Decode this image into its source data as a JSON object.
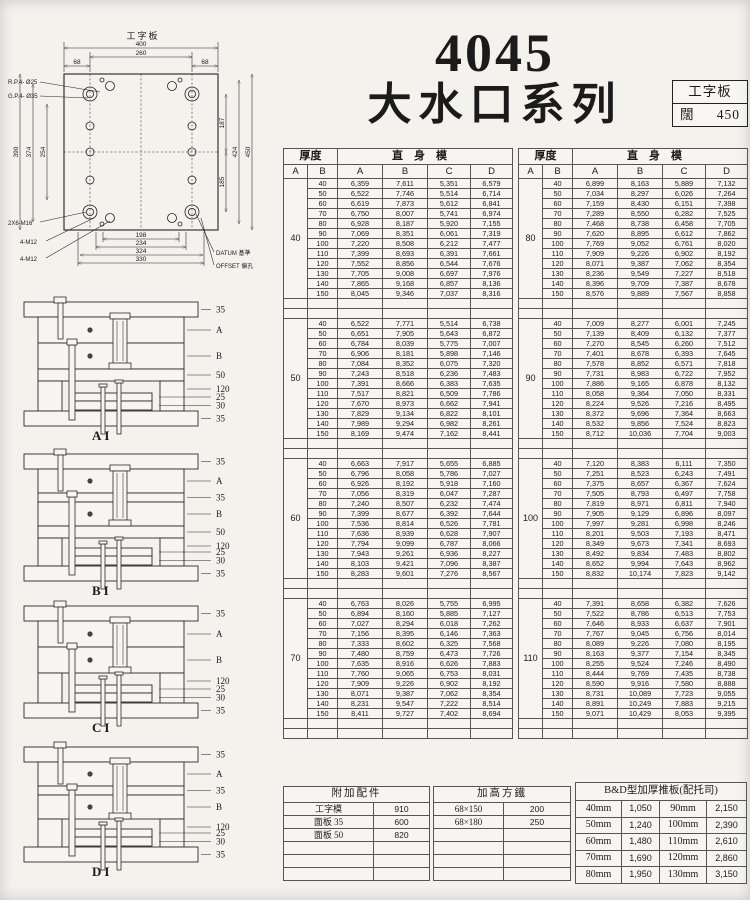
{
  "theme": {
    "paper": "#f3f2ed",
    "ink": "#1b1b1b"
  },
  "header": {
    "model": "4045",
    "series": "大水口系列",
    "spec_box": {
      "row1": "工字板",
      "row2_label": "闊",
      "row2_value": "450"
    }
  },
  "plan": {
    "label": "工字板",
    "dims": {
      "overall_w": "400",
      "inner_w": "260",
      "edge_l": "68",
      "edge_r": "68",
      "left_outer": "390",
      "left_mid": "374",
      "left_inner": "254",
      "right_top": "187",
      "right_bottom": "185",
      "right_outer1": "424",
      "right_outer2": "450",
      "bottom1": "198",
      "bottom2": "234",
      "bottom3": "324",
      "bottom4": "330"
    },
    "annotations": {
      "rp": "R.P.4- Ø25",
      "gp": "G.P.4- Ø35",
      "m16": "2X6-M16",
      "m12_upper": "4-M12",
      "m12_lower": "4-M12",
      "datum": "DATUM 基準",
      "offset": "OFFSET 偏孔"
    }
  },
  "cross_sections": [
    {
      "caption": "AI",
      "labels": [
        "35",
        "A",
        "B",
        "50",
        "120",
        "25",
        "30",
        "35"
      ]
    },
    {
      "caption": "BI",
      "labels": [
        "35",
        "A",
        "35",
        "B",
        "50",
        "120",
        "25",
        "30",
        "35"
      ]
    },
    {
      "caption": "CI",
      "labels": [
        "35",
        "A",
        "B",
        "120",
        "25",
        "30",
        "35"
      ]
    },
    {
      "caption": "DI",
      "labels": [
        "35",
        "A",
        "35",
        "B",
        "120",
        "25",
        "30",
        "35"
      ]
    }
  ],
  "price_tables": [
    {
      "thickness_header": "厚度",
      "straight_header": "直身模",
      "sub_cols": [
        "A",
        "B",
        "A",
        "B",
        "C",
        "D"
      ],
      "groups": [
        {
          "thickness": "40",
          "rows": [
            [
              "40",
              "6,359",
              "7,611",
              "5,351",
              "6,579"
            ],
            [
              "50",
              "6,522",
              "7,746",
              "5,514",
              "6,714"
            ],
            [
              "60",
              "6,619",
              "7,873",
              "5,612",
              "6,841"
            ],
            [
              "70",
              "6,750",
              "8,007",
              "5,741",
              "6,974"
            ],
            [
              "80",
              "6,928",
              "8,187",
              "5,920",
              "7,155"
            ],
            [
              "90",
              "7,069",
              "8,351",
              "6,061",
              "7,319"
            ],
            [
              "100",
              "7,220",
              "8,508",
              "6,212",
              "7,477"
            ],
            [
              "110",
              "7,399",
              "8,693",
              "6,391",
              "7,661"
            ],
            [
              "120",
              "7,552",
              "8,856",
              "6,544",
              "7,676"
            ],
            [
              "130",
              "7,705",
              "9,008",
              "6,697",
              "7,976"
            ],
            [
              "140",
              "7,865",
              "9,168",
              "6,857",
              "8,136"
            ],
            [
              "150",
              "8,045",
              "9,346",
              "7,037",
              "8,316"
            ]
          ]
        },
        {
          "thickness": "50",
          "rows": [
            [
              "40",
              "6,522",
              "7,771",
              "5,514",
              "6,738"
            ],
            [
              "50",
              "6,651",
              "7,905",
              "5,643",
              "6,872"
            ],
            [
              "60",
              "6,784",
              "8,039",
              "5,775",
              "7,007"
            ],
            [
              "70",
              "6,906",
              "8,181",
              "5,898",
              "7,146"
            ],
            [
              "80",
              "7,084",
              "8,352",
              "6,075",
              "7,320"
            ],
            [
              "90",
              "7,243",
              "8,518",
              "6,236",
              "7,483"
            ],
            [
              "100",
              "7,391",
              "8,666",
              "6,383",
              "7,635"
            ],
            [
              "110",
              "7,517",
              "8,821",
              "6,509",
              "7,786"
            ],
            [
              "120",
              "7,670",
              "8,973",
              "6,662",
              "7,941"
            ],
            [
              "130",
              "7,829",
              "9,134",
              "6,822",
              "8,101"
            ],
            [
              "140",
              "7,989",
              "9,294",
              "6,982",
              "8,261"
            ],
            [
              "150",
              "8,169",
              "9,474",
              "7,162",
              "8,441"
            ]
          ]
        },
        {
          "thickness": "60",
          "rows": [
            [
              "40",
              "6,663",
              "7,917",
              "5,655",
              "6,885"
            ],
            [
              "50",
              "6,796",
              "8,058",
              "5,786",
              "7,027"
            ],
            [
              "60",
              "6,926",
              "8,192",
              "5,918",
              "7,160"
            ],
            [
              "70",
              "7,056",
              "8,319",
              "6,047",
              "7,287"
            ],
            [
              "80",
              "7,240",
              "8,507",
              "6,232",
              "7,474"
            ],
            [
              "90",
              "7,399",
              "8,677",
              "6,392",
              "7,644"
            ],
            [
              "100",
              "7,536",
              "8,814",
              "6,526",
              "7,781"
            ],
            [
              "110",
              "7,636",
              "8,939",
              "6,628",
              "7,907"
            ],
            [
              "120",
              "7,794",
              "9,099",
              "6,787",
              "8,066"
            ],
            [
              "130",
              "7,943",
              "9,261",
              "6,936",
              "8,227"
            ],
            [
              "140",
              "8,103",
              "9,421",
              "7,096",
              "8,387"
            ],
            [
              "150",
              "8,283",
              "9,601",
              "7,276",
              "8,567"
            ]
          ]
        },
        {
          "thickness": "70",
          "rows": [
            [
              "40",
              "6,763",
              "8,026",
              "5,755",
              "6,995"
            ],
            [
              "50",
              "6,894",
              "8,160",
              "5,885",
              "7,127"
            ],
            [
              "60",
              "7,027",
              "8,294",
              "6,018",
              "7,262"
            ],
            [
              "70",
              "7,156",
              "8,395",
              "6,146",
              "7,363"
            ],
            [
              "80",
              "7,333",
              "8,602",
              "6,325",
              "7,568"
            ],
            [
              "90",
              "7,480",
              "8,759",
              "6,473",
              "7,726"
            ],
            [
              "100",
              "7,635",
              "8,916",
              "6,626",
              "7,883"
            ],
            [
              "110",
              "7,760",
              "9,065",
              "6,753",
              "8,031"
            ],
            [
              "120",
              "7,909",
              "9,226",
              "6,902",
              "8,192"
            ],
            [
              "130",
              "8,071",
              "9,387",
              "7,062",
              "8,354"
            ],
            [
              "140",
              "8,231",
              "9,547",
              "7,222",
              "8,514"
            ],
            [
              "150",
              "8,411",
              "9,727",
              "7,402",
              "8,694"
            ]
          ]
        }
      ]
    },
    {
      "thickness_header": "厚度",
      "straight_header": "直身模",
      "sub_cols": [
        "A",
        "B",
        "A",
        "B",
        "C",
        "D"
      ],
      "groups": [
        {
          "thickness": "80",
          "rows": [
            [
              "40",
              "6,899",
              "8,163",
              "5,889",
              "7,132"
            ],
            [
              "50",
              "7,034",
              "8,297",
              "6,026",
              "7,264"
            ],
            [
              "60",
              "7,159",
              "8,430",
              "6,151",
              "7,398"
            ],
            [
              "70",
              "7,289",
              "8,550",
              "6,282",
              "7,525"
            ],
            [
              "80",
              "7,468",
              "8,738",
              "6,458",
              "7,705"
            ],
            [
              "90",
              "7,620",
              "8,895",
              "6,612",
              "7,862"
            ],
            [
              "100",
              "7,769",
              "9,052",
              "6,761",
              "8,020"
            ],
            [
              "110",
              "7,909",
              "9,226",
              "6,902",
              "8,192"
            ],
            [
              "120",
              "8,071",
              "9,387",
              "7,062",
              "8,354"
            ],
            [
              "130",
              "8,236",
              "9,549",
              "7,227",
              "8,518"
            ],
            [
              "140",
              "8,396",
              "9,709",
              "7,387",
              "8,678"
            ],
            [
              "150",
              "8,576",
              "9,889",
              "7,567",
              "8,858"
            ]
          ]
        },
        {
          "thickness": "90",
          "rows": [
            [
              "40",
              "7,009",
              "8,277",
              "6,001",
              "7,245"
            ],
            [
              "50",
              "7,139",
              "8,409",
              "6,132",
              "7,377"
            ],
            [
              "60",
              "7,270",
              "8,545",
              "6,260",
              "7,512"
            ],
            [
              "70",
              "7,401",
              "8,678",
              "6,393",
              "7,645"
            ],
            [
              "80",
              "7,578",
              "8,852",
              "6,571",
              "7,818"
            ],
            [
              "90",
              "7,731",
              "8,983",
              "6,722",
              "7,952"
            ],
            [
              "100",
              "7,886",
              "9,165",
              "6,878",
              "8,132"
            ],
            [
              "110",
              "8,058",
              "9,364",
              "7,050",
              "8,331"
            ],
            [
              "120",
              "8,224",
              "9,526",
              "7,216",
              "8,495"
            ],
            [
              "130",
              "8,372",
              "9,696",
              "7,364",
              "8,663"
            ],
            [
              "140",
              "8,532",
              "9,856",
              "7,524",
              "8,823"
            ],
            [
              "150",
              "8,712",
              "10,036",
              "7,704",
              "9,003"
            ]
          ]
        },
        {
          "thickness": "100",
          "rows": [
            [
              "40",
              "7,120",
              "8,383",
              "6,111",
              "7,350"
            ],
            [
              "50",
              "7,251",
              "8,523",
              "6,243",
              "7,491"
            ],
            [
              "60",
              "7,375",
              "8,657",
              "6,367",
              "7,624"
            ],
            [
              "70",
              "7,505",
              "8,793",
              "6,497",
              "7,758"
            ],
            [
              "80",
              "7,819",
              "8,971",
              "6,811",
              "7,940"
            ],
            [
              "90",
              "7,905",
              "9,129",
              "6,896",
              "8,097"
            ],
            [
              "100",
              "7,997",
              "9,281",
              "6,998",
              "8,246"
            ],
            [
              "110",
              "8,201",
              "9,503",
              "7,193",
              "8,471"
            ],
            [
              "120",
              "8,349",
              "9,673",
              "7,341",
              "8,693"
            ],
            [
              "130",
              "8,492",
              "9,834",
              "7,483",
              "8,802"
            ],
            [
              "140",
              "8,652",
              "9,994",
              "7,643",
              "8,962"
            ],
            [
              "150",
              "8,832",
              "10,174",
              "7,823",
              "9,142"
            ]
          ]
        },
        {
          "thickness": "110",
          "rows": [
            [
              "40",
              "7,391",
              "8,658",
              "6,382",
              "7,626"
            ],
            [
              "50",
              "7,522",
              "8,786",
              "6,513",
              "7,753"
            ],
            [
              "60",
              "7,646",
              "8,933",
              "6,637",
              "7,901"
            ],
            [
              "70",
              "7,767",
              "9,045",
              "6,756",
              "8,014"
            ],
            [
              "80",
              "8,089",
              "9,226",
              "7,080",
              "8,195"
            ],
            [
              "90",
              "8,163",
              "9,377",
              "7,154",
              "8,345"
            ],
            [
              "100",
              "8,255",
              "9,524",
              "7,246",
              "8,490"
            ],
            [
              "110",
              "8,444",
              "9,769",
              "7,435",
              "8,738"
            ],
            [
              "120",
              "8,590",
              "9,916",
              "7,580",
              "8,888"
            ],
            [
              "130",
              "8,731",
              "10,089",
              "7,723",
              "9,055"
            ],
            [
              "140",
              "8,891",
              "10,249",
              "7,883",
              "9,215"
            ],
            [
              "150",
              "9,071",
              "10,429",
              "8,053",
              "9,395"
            ]
          ]
        }
      ]
    }
  ],
  "accessories": {
    "title": "附加配件",
    "rows": [
      [
        "工字模",
        "910"
      ],
      [
        "面板 35",
        "600"
      ],
      [
        "面板 50",
        "820"
      ]
    ],
    "empty_rows": 3
  },
  "risers": {
    "title": "加高方鐵",
    "rows": [
      [
        "68×150",
        "200"
      ],
      [
        "68×180",
        "250"
      ]
    ],
    "empty_rows": 4
  },
  "bd_plate": {
    "title": "B&D型加厚推板(配托司)",
    "rows": [
      [
        "40mm",
        "1,050",
        "90mm",
        "2,150"
      ],
      [
        "50mm",
        "1,240",
        "100mm",
        "2,390"
      ],
      [
        "60mm",
        "1,480",
        "110mm",
        "2,610"
      ],
      [
        "70mm",
        "1,690",
        "120mm",
        "2,860"
      ],
      [
        "80mm",
        "1,950",
        "130mm",
        "3,150"
      ]
    ]
  }
}
